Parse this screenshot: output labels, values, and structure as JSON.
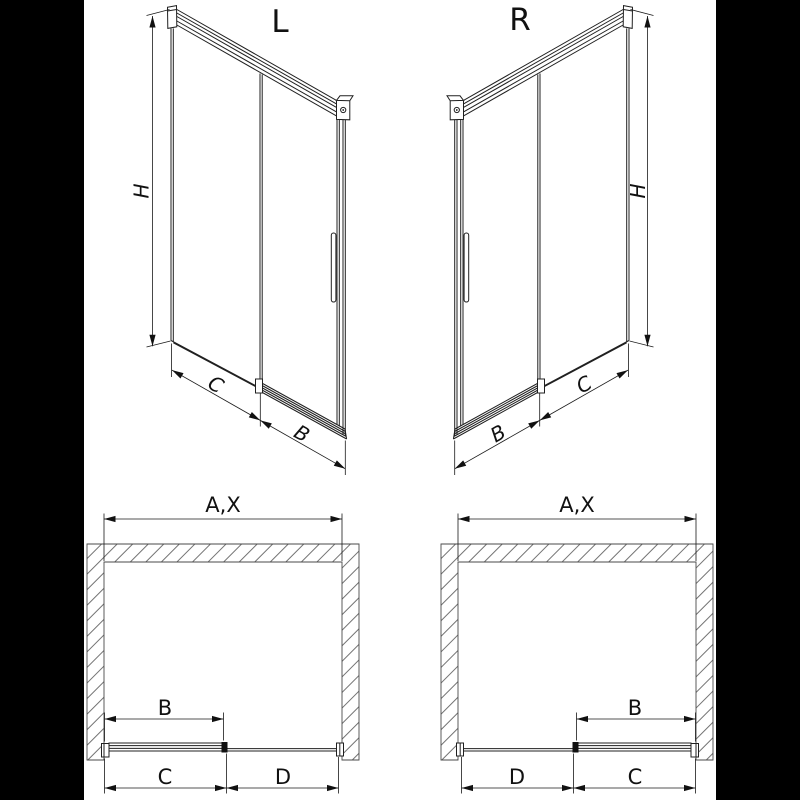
{
  "canvas": {
    "letterbox_color": "#000000",
    "paper_color": "#ffffff",
    "line_color": "#1a1a1a"
  },
  "drawing": {
    "iso_left": {
      "variant": "L",
      "h": "H",
      "c": "C",
      "b": "B"
    },
    "iso_right": {
      "variant": "R",
      "h": "H",
      "c": "C",
      "b": "B"
    },
    "plan_left": {
      "ax": "A,X",
      "b": "B",
      "c": "C",
      "d": "D"
    },
    "plan_right": {
      "ax": "A,X",
      "b": "B",
      "d": "D",
      "c": "C"
    }
  }
}
